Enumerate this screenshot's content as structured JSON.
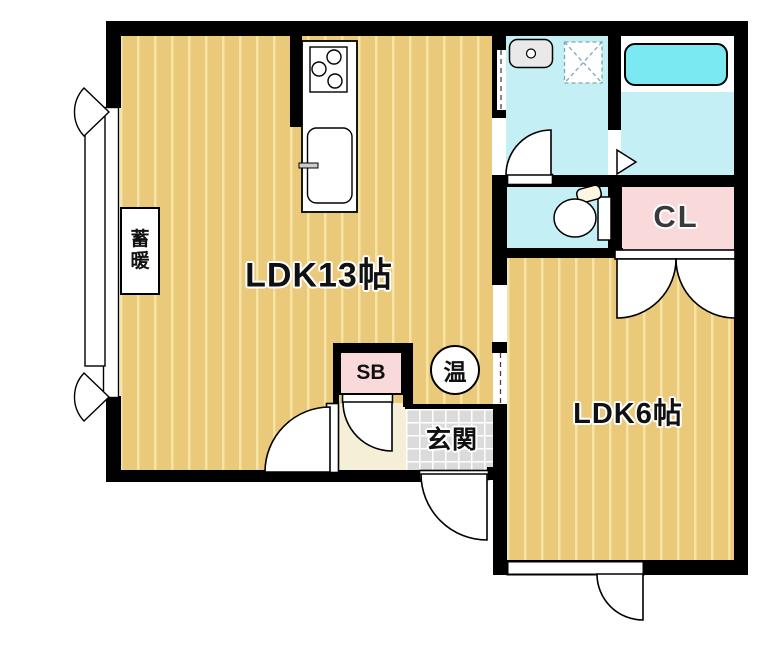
{
  "floorplan": {
    "rooms": {
      "ldk13": {
        "label": "LDK13帖"
      },
      "ldk6": {
        "label": "LDK6帖"
      },
      "closet": {
        "label": "CL"
      },
      "entrance": {
        "label": "玄関"
      },
      "shoe_box": {
        "label": "SB"
      },
      "water_heater": {
        "label": "温"
      },
      "storage_heater": {
        "label": "蓄暖"
      }
    },
    "fixtures": [
      "stove-icon",
      "kitchen-sink-icon",
      "wash-basin-icon",
      "washing-machine-pan-icon",
      "bathtub-icon",
      "toilet-icon",
      "door-swing-icon",
      "window-casement-icon"
    ],
    "colors": {
      "floor_tan": "#ebc97b",
      "floor_stripe": "#f5e4a4",
      "wet_room_cyan": "#c4f0f5",
      "bathtub_cyan": "#7be9f2",
      "closet_pink": "#f9d9da",
      "entrance_tile_gray": "#dbdbdb",
      "hall_cream": "#f6efd8",
      "wall_black": "#000000"
    }
  }
}
